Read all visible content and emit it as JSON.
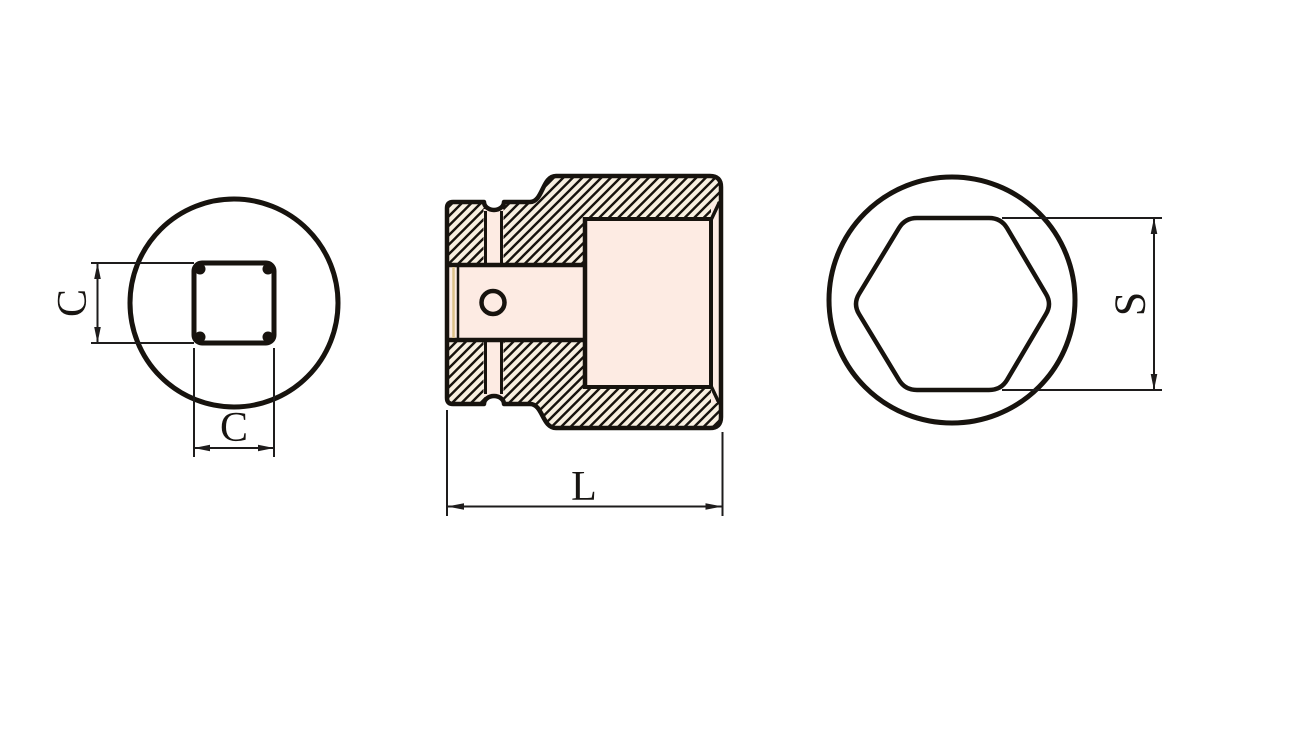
{
  "drawing": {
    "type": "technical-drawing",
    "subject": "impact socket - three orthographic views",
    "views": [
      {
        "id": "front",
        "description": "end view with square drive opening"
      },
      {
        "id": "section",
        "description": "hatched longitudinal cross-section with retaining pin hole, ring groove and hexagonal cavity"
      },
      {
        "id": "rear",
        "description": "end view with hexagonal opening"
      }
    ],
    "labels": {
      "square_height": "C",
      "square_width": "C",
      "overall_length": "L",
      "hex_across_flats": "S"
    },
    "colors": {
      "outline": "#17130e",
      "dimension_line": "#1e1c1c",
      "label_color": "#181512",
      "body_fill_center": "#fdf3ea",
      "body_fill_edge": "#f9e6d4",
      "opening_fill": "#fdf0e9",
      "cavity_fill": "#fdebe3",
      "hatch_background": "#f8f0e1",
      "groove_accent": "#ddc289",
      "background": "#ffffff"
    }
  }
}
